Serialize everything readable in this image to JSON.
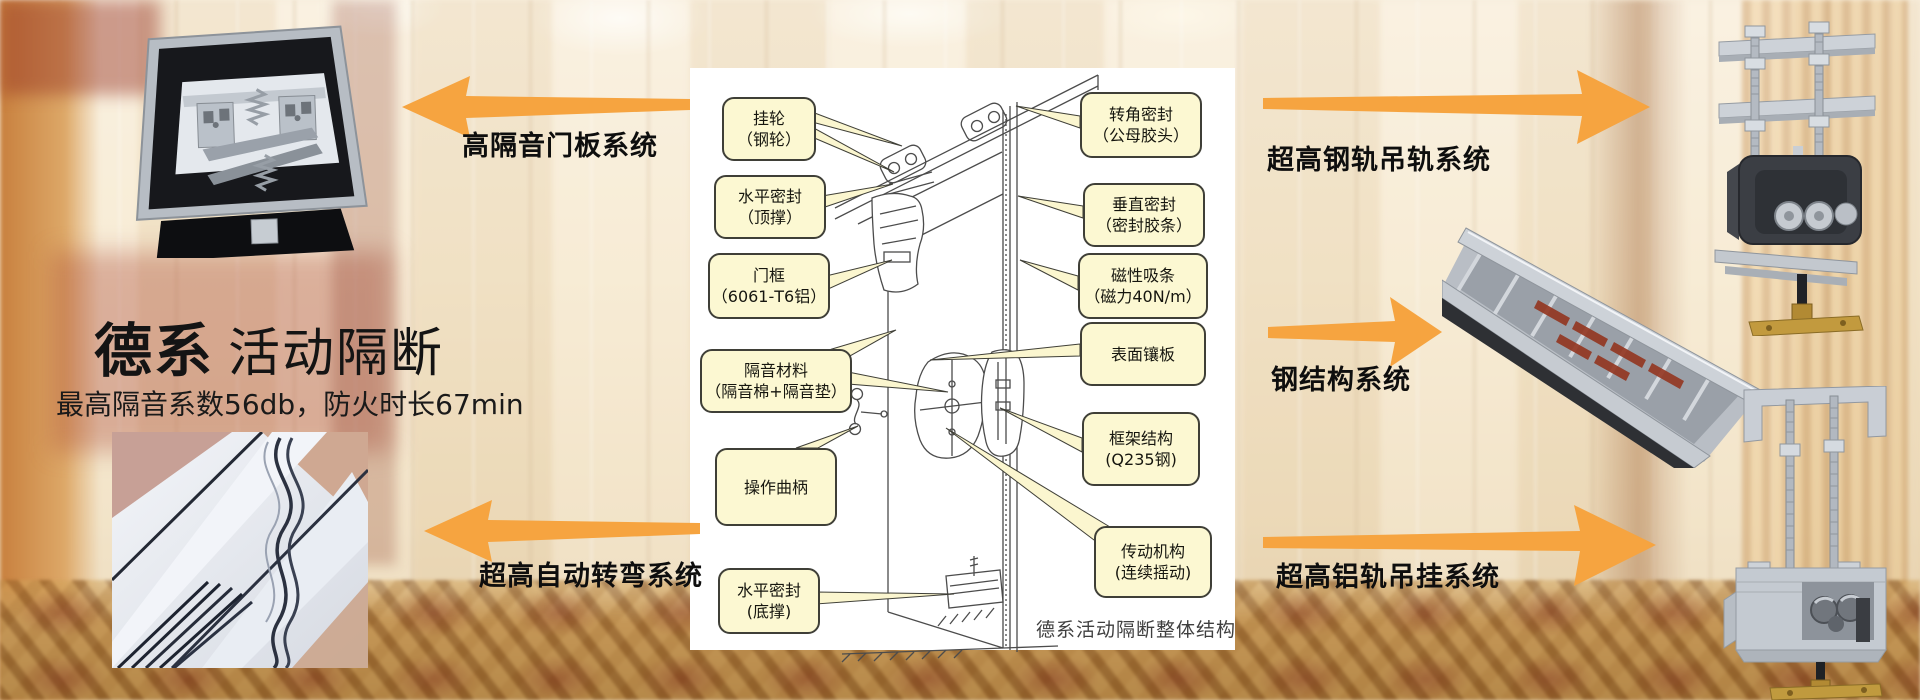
{
  "hero": {
    "title_bold": "德系",
    "title_rest": "活动隔断",
    "subtitle": "最高隔音系数56db，防火时长67min"
  },
  "systems": {
    "door_panel": "高隔音门板系统",
    "auto_turning": "超高自动转弯系统",
    "steel_rail": "超高钢轨吊轨系统",
    "steel_structure": "钢结构系统",
    "aluminum_rail": "超高铝轨吊挂系统"
  },
  "diagram": {
    "caption": "德系活动隔断整体结构",
    "left_callouts": [
      {
        "line1": "挂轮",
        "line2": "（钢轮）"
      },
      {
        "line1": "水平密封",
        "line2": "（顶撑）"
      },
      {
        "line1": "门框",
        "line2": "（6061-T6铝）"
      },
      {
        "line1": "隔音材料",
        "line2": "（隔音棉+隔音垫）"
      },
      {
        "line1": "操作曲柄",
        "line2": ""
      },
      {
        "line1": "水平密封",
        "line2": "(底撑)"
      }
    ],
    "right_callouts": [
      {
        "line1": "转角密封",
        "line2": "（公母胶头）"
      },
      {
        "line1": "垂直密封",
        "line2": "（密封胶条）"
      },
      {
        "line1": "磁性吸条",
        "line2": "（磁力40N/m）"
      },
      {
        "line1": "表面镶板",
        "line2": ""
      },
      {
        "line1": "框架结构",
        "line2": "(Q235钢)"
      },
      {
        "line1": "传动机构",
        "line2": "(连续摇动)"
      }
    ]
  },
  "colors": {
    "arrow_orange": "#F6A440",
    "callout_fill": "#FCF8D2",
    "callout_border": "#3F3F37",
    "panel_white": "#FFFFFF"
  }
}
